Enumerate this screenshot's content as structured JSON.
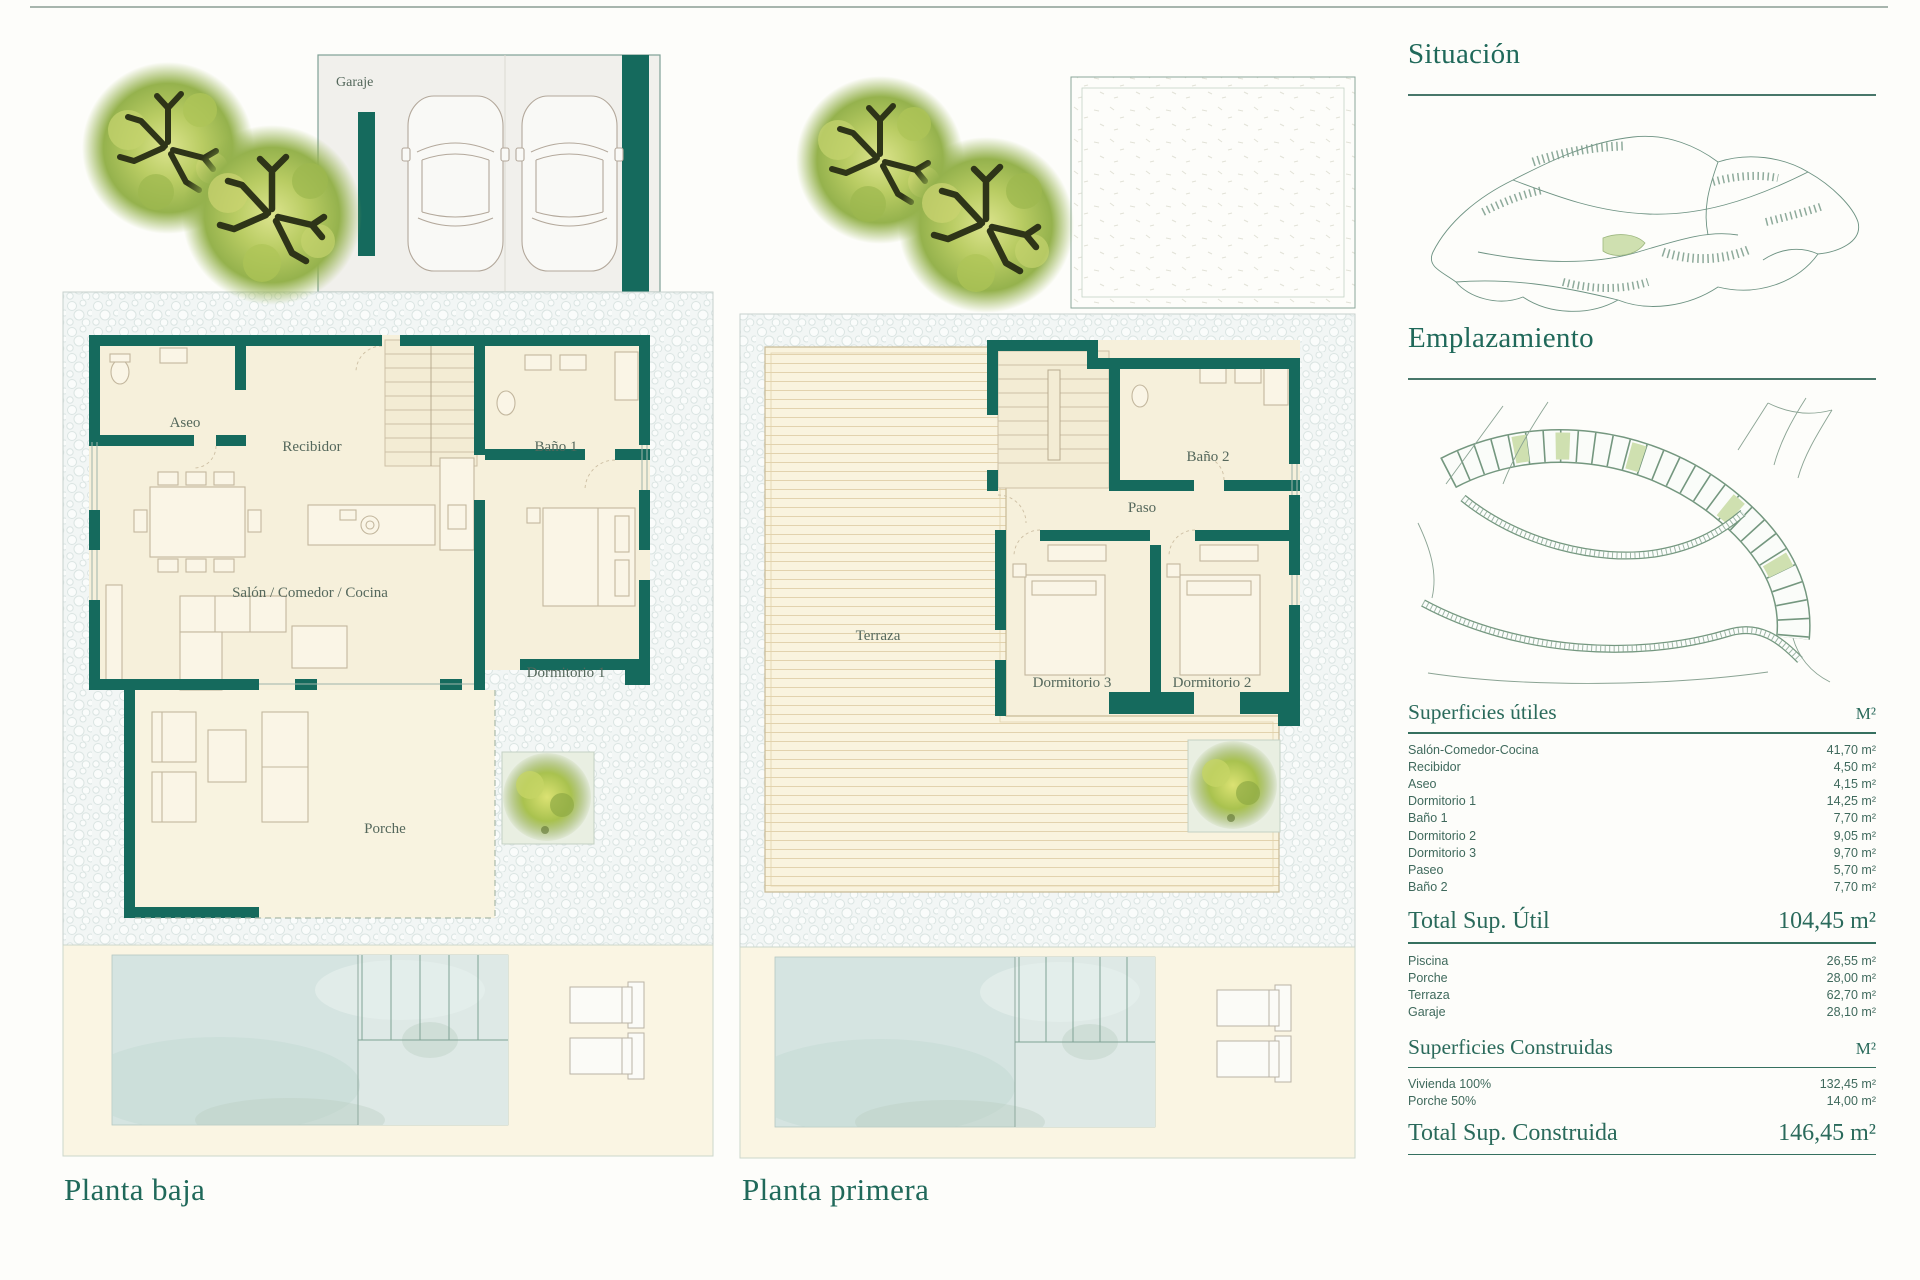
{
  "colors": {
    "wall_teal": "#156a5d",
    "title_green": "#20695a",
    "highlight_plot_green": "#cfe0b0",
    "room_cream": "#f6f0db",
    "pool_blue": "#d5e4e1"
  },
  "sidebar": {
    "situacion_title": "Situación",
    "emplazamiento_title": "Emplazamiento"
  },
  "plans": {
    "ground": {
      "title": "Planta baja",
      "garage": "Garaje",
      "aseo": "Aseo",
      "recibidor": "Recibidor",
      "bano1": "Baño 1",
      "salon": "Salón / Comedor / Cocina",
      "dormitorio1": "Dormitorio 1",
      "porche": "Porche"
    },
    "first": {
      "title": "Planta primera",
      "terraza": "Terraza",
      "bano2": "Baño 2",
      "paso": "Paso",
      "dormitorio3": "Dormitorio 3",
      "dormitorio2": "Dormitorio 2"
    }
  },
  "tables": {
    "useful": {
      "title": "Superficies útiles",
      "unit": "M²",
      "rows": [
        {
          "label": "Salón-Comedor-Cocina",
          "value": "41,70 m²"
        },
        {
          "label": "Recibidor",
          "value": "4,50 m²"
        },
        {
          "label": "Aseo",
          "value": "4,15 m²"
        },
        {
          "label": "Dormitorio 1",
          "value": "14,25 m²"
        },
        {
          "label": "Baño 1",
          "value": "7,70 m²"
        },
        {
          "label": "Dormitorio 2",
          "value": "9,05 m²"
        },
        {
          "label": "Dormitorio 3",
          "value": "9,70 m²"
        },
        {
          "label": "Paseo",
          "value": "5,70 m²"
        },
        {
          "label": "Baño 2",
          "value": "7,70 m²"
        }
      ],
      "total_label": "Total Sup. Útil",
      "total_value": "104,45 m²",
      "annex_rows": [
        {
          "label": "Piscina",
          "value": "26,55 m²"
        },
        {
          "label": "Porche",
          "value": "28,00 m²"
        },
        {
          "label": "Terraza",
          "value": "62,70 m²"
        },
        {
          "label": "Garaje",
          "value": "28,10 m²"
        }
      ]
    },
    "built": {
      "title": "Superficies Construidas",
      "unit": "M²",
      "rows": [
        {
          "label": "Vivienda 100%",
          "value": "132,45 m²"
        },
        {
          "label": "Porche 50%",
          "value": "14,00 m²"
        }
      ],
      "total_label": "Total Sup. Construida",
      "total_value": "146,45 m²"
    }
  }
}
